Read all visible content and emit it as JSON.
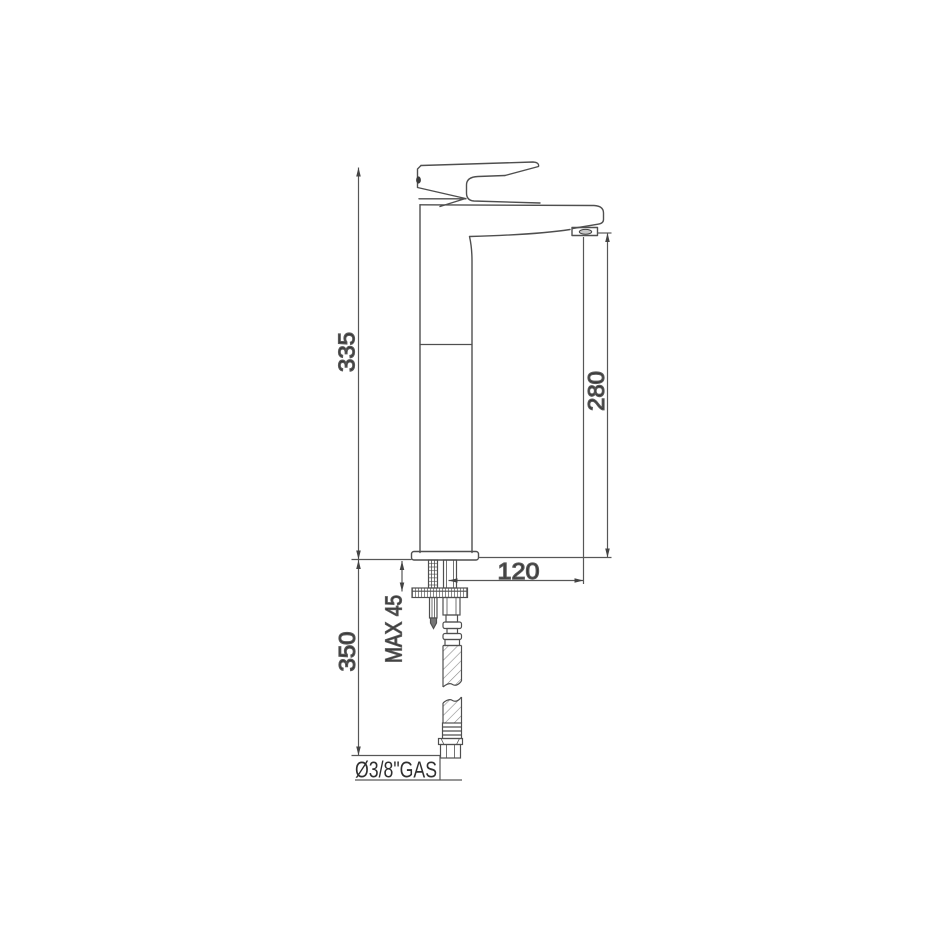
{
  "drawing": {
    "background": "#ffffff",
    "line_color": "#4f4f4f",
    "dim_color": "#575757",
    "text_color": "#2f2f2f",
    "dimensions": {
      "total_height": "335",
      "below_deck_height": "350",
      "spout_outlet_height": "280",
      "spout_reach": "120",
      "max_deck_thickness": "MAX 45",
      "hose_connection": "Ø3/8\"GAS"
    }
  }
}
